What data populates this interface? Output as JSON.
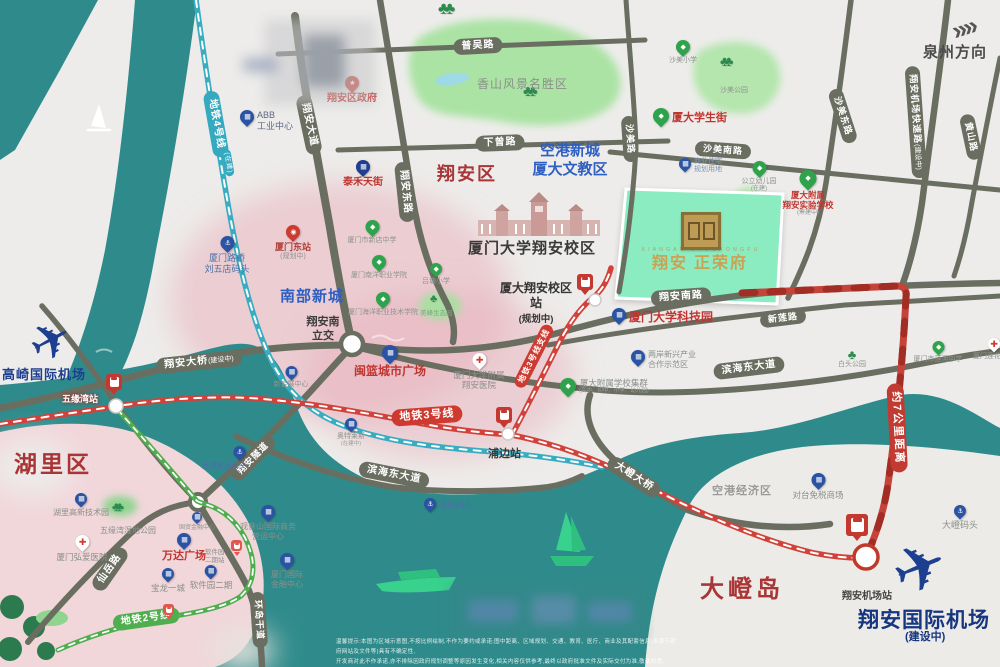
{
  "regions": {
    "xiangan": "翔安区",
    "huli": "湖里区",
    "dadeng": "大嶝岛",
    "nanbu": "南部新城",
    "konggang_line1": "空港新城",
    "konggang_line2": "厦大文教区",
    "konggang_economic": "空港经济区",
    "xiangshan_scenic": "香山风景名胜区",
    "campus": "厦门大学翔安校区",
    "interchange": "翔安南\n立交",
    "quanzhou": "泉州方向",
    "quanzhou_arrows": "»"
  },
  "project": {
    "name": "翔安 正荣府",
    "latin": "X I A N G A N · Z H E N R O N G F U"
  },
  "airports": {
    "gaoqi": "高崎国际机场",
    "xiangan": "翔安国际机场",
    "xiangan_note": "(建设中)"
  },
  "roads": {
    "puwu": "普吴路",
    "xiacen": "下曾路",
    "xiangan_avenue": "翔安大道",
    "xiangan_east": "翔安东路",
    "shamei": "沙美路",
    "shamei_south": "沙美南路",
    "shamei_east": "沙美东路",
    "airport_express": "翔安机场快速路",
    "airport_express_note": "(建设中)",
    "huangshan": "黄山路",
    "xiangan_south": "翔安南路",
    "xinlian": "新莲路",
    "binhai_east": "滨海东大道",
    "binhai_east2": "滨海东大道",
    "dadeng_bridge": "大嶝大桥",
    "xiangan_bridge": "翔安大桥",
    "xiangan_bridge_note": "(建设中)",
    "xianyue": "仙岳路",
    "tunnel": "翔安隧道",
    "huandao": "环岛干道"
  },
  "metro": {
    "line4": "地铁4号线",
    "line4_note": "(在建)",
    "line3": "地铁3号线",
    "line3_branch": "地铁3号线支线",
    "line2": "地铁2号线",
    "distance": "约7公里距离"
  },
  "stations": {
    "wuyuanwan": "五缘湾站",
    "pubian": "浦边站",
    "campus": "厦大翔安校区站",
    "campus_note": "(规划中)",
    "airport": "翔安机场站",
    "software": "软件园\n二期站",
    "xiamen_east": "厦门东站",
    "xiamen_east_note": "(规划中)"
  },
  "pois": {
    "gov": "翔安区政府",
    "abb": "ABB\n工业中心",
    "taihe": "泰禾天街",
    "shamei_primary": "沙美小学",
    "shamei_park": "沙美公园",
    "xiada_street": "厦大学生街",
    "kindergarten": "公立幼儿园",
    "kindergarten_note": "(在建)",
    "affiliated_school": "厦大附属\n翔安实验学校",
    "affiliated_school_note": "(筹建中)",
    "biz_land": "商业住宅\n规划用地",
    "tech_park": "厦门大学科技园",
    "coop_zone": "两岸新兴产业\n合作示范区",
    "school_cluster": "厦大附属学校集群",
    "school_cluster_note": "(高中、初中、小学、幼儿园)",
    "hospital": "厦门大学附属\n翔安医院",
    "minlan": "闽篮城市广场",
    "expo": "新会展中心",
    "outlets": "奥特莱斯",
    "outlets_note": "(在建中)",
    "xindian_school": "厦门市新店中学",
    "nanyang": "厦门南洋职业学院",
    "ocean_college": "厦门海洋职业技术学院",
    "lvtang": "吕塘小学",
    "meifeng": "美峰生态园",
    "liuwudian": "厦门路桥\n刘五店码头",
    "wutong": "五通客运码头",
    "haixiang": "海翔码头",
    "dadeng_wharf": "大嶝码头",
    "duty_free": "对台免税商场",
    "lianhe_school": "厦门市莲河中学",
    "baitou": "白头公园",
    "lianhua_hospital": "厦门莲花医院",
    "hongai": "厦门弘爱医院",
    "hi_tech": "湖里高新技术园",
    "wetland": "五缘湾湿地公园",
    "wanda": "万达广场",
    "guomao": "国贸金融中心",
    "software_park": "软件园二期",
    "guanyinshan": "观音山国际商务\n营运中心",
    "intl_finance": "厦门国际\n金融中心",
    "baolong": "宝龙一城"
  },
  "footer": {
    "disclaimer_line1": "温馨提示:本图为区域示意图,不按比例绘制,不作为要约或承诺;图中距离、区域规划、交通、教育、医疗、商业及其配套信息(来源于政府网站及文件等)具有不确定性,",
    "disclaimer_line2": "开发商对此不作承诺,亦不排除因政府规划调整等原因发生变化,相关内容仅供参考,最终以政府批准文件及实际交付为准,敬请知悉。"
  }
}
